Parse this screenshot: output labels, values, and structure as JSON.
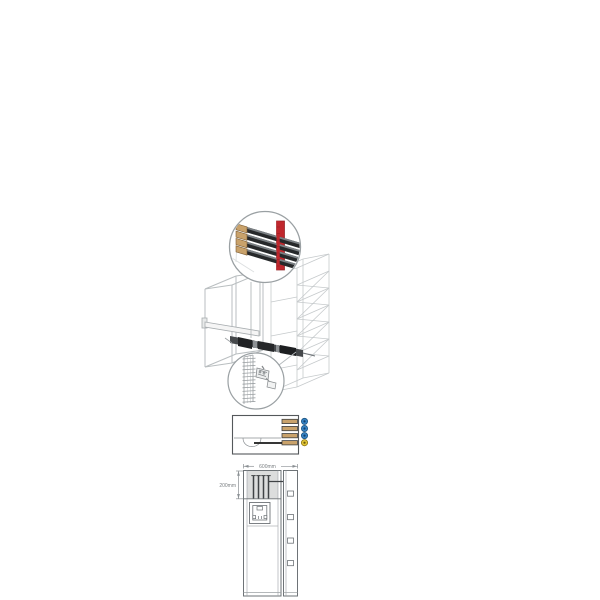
{
  "illustration": {
    "title": "vertical-busbars-installation-drawing",
    "busbar_detail": {
      "busbar_count": 4,
      "holder": "red-busbar-holder"
    },
    "support_detail": {
      "part": "ribbed-busbar-support-with-clamp"
    },
    "top_view": {
      "busbar_count": 4,
      "dot_colors": [
        "#3584c6",
        "#3584c6",
        "#3584c6",
        "#e2c535"
      ],
      "dot_rings": [
        "#1d5480",
        "#1d5480",
        "#1d5480",
        "#8a7413"
      ],
      "dot_centers": [
        "#14406e",
        "#14406e",
        "#14406e",
        "#6b5a0e"
      ]
    },
    "front_view": {
      "width_dim": "600mm",
      "depth_dim": "200mm",
      "hinge_count": 4
    }
  },
  "colors": {
    "line": "#9ba0a3",
    "line_light": "#c6cacc",
    "frame": "#6e7377",
    "dark_bar": "#26282a",
    "bar_bevel": "#7b8084",
    "assembly": "#45484b",
    "copper": "#c9a26b",
    "copper_edge": "#7c5c33",
    "copper_outline": "#3f4143",
    "red": "#c0272d",
    "red_dark": "#8e1d22",
    "shade": "#dcdddd",
    "dim_text": "#7a7f82",
    "black_line": "#1a1a1a",
    "busbar_line": "#3f4245"
  }
}
